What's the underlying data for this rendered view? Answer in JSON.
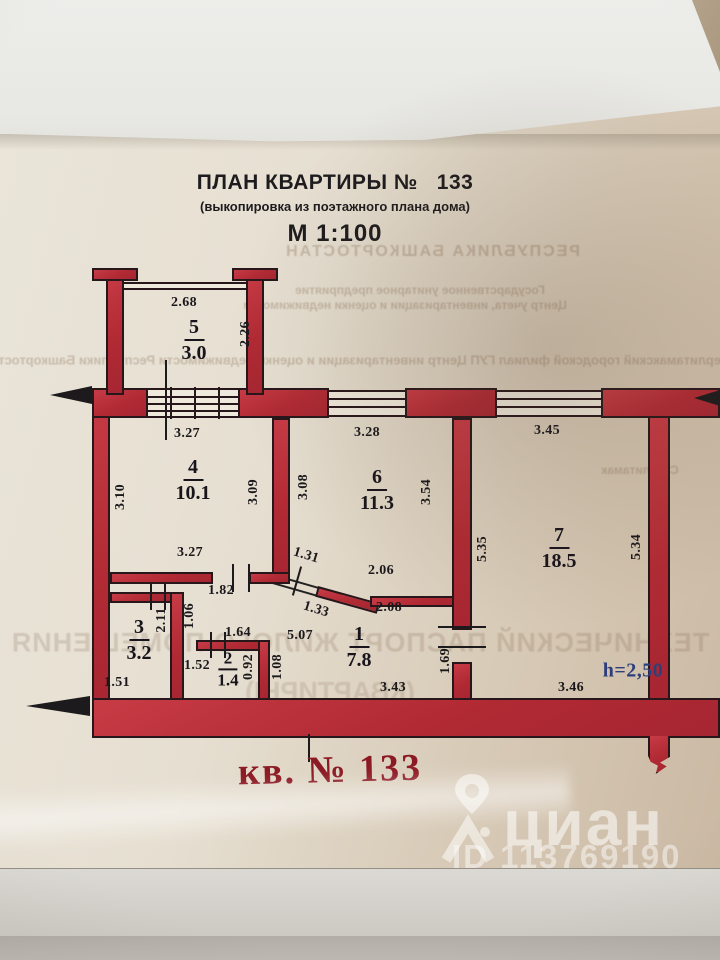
{
  "document": {
    "title": "ПЛАН КВАРТИРЫ №",
    "title_number": "133",
    "subtitle": "(выкопировка из поэтажного плана дома)",
    "scale_label": "М 1:100",
    "apartment_caption": "кв. № 133",
    "ceiling_height": "h=2,50"
  },
  "plan": {
    "rooms": [
      {
        "num": "5",
        "area": "3.0"
      },
      {
        "num": "4",
        "area": "10.1"
      },
      {
        "num": "6",
        "area": "11.3"
      },
      {
        "num": "7",
        "area": "18.5"
      },
      {
        "num": "3",
        "area": "3.2"
      },
      {
        "num": "2",
        "area": "1.4"
      },
      {
        "num": "1",
        "area": "7.8"
      }
    ],
    "dimensions": {
      "d268": "2.68",
      "d226": "2.26",
      "d327a": "3.27",
      "d328": "3.28",
      "d345": "3.45",
      "d310": "3.10",
      "d309": "3.09",
      "d308": "3.08",
      "d354": "3.54",
      "d535": "5.35",
      "d534": "5.34",
      "d327b": "3.27",
      "d131": "1.31",
      "d206": "2.06",
      "d133": "1.33",
      "d208": "2.08",
      "d182": "1.82",
      "d211": "2.11",
      "d106": "1.06",
      "d164": "1.64",
      "d507": "5.07",
      "d152": "1.52",
      "d092": "0.92",
      "d108": "1.08",
      "d169": "1.69",
      "d151": "1.51",
      "d343": "3.43",
      "d346": "3.46"
    }
  },
  "watermark": {
    "brand": "циан",
    "listing_id": "ID 113769190"
  },
  "bleedthrough": {
    "line1": "РЕСПУБЛИКА БАШКОРТОСТАН",
    "line2": "Государственное унитарное предприятие",
    "line3": "Центр учета, инвентаризации и оценки недвижимости",
    "line4": "Стерлитамакский городской филиал ГУП Центр инвентаризации и оценки недвижимости Республики Башкортостан",
    "line5": "Стерлитамак",
    "line6": "ТЕХНИЧЕСКИЙ ПАСПОРТ ЖИЛОГО ПОМЕЩЕНИЯ",
    "line7": "(КВАРТИРЫ)"
  },
  "colors": {
    "wall_red": "#bf2f38",
    "caption_red": "#8c1a24",
    "height_blue": "#2c3f7c"
  }
}
